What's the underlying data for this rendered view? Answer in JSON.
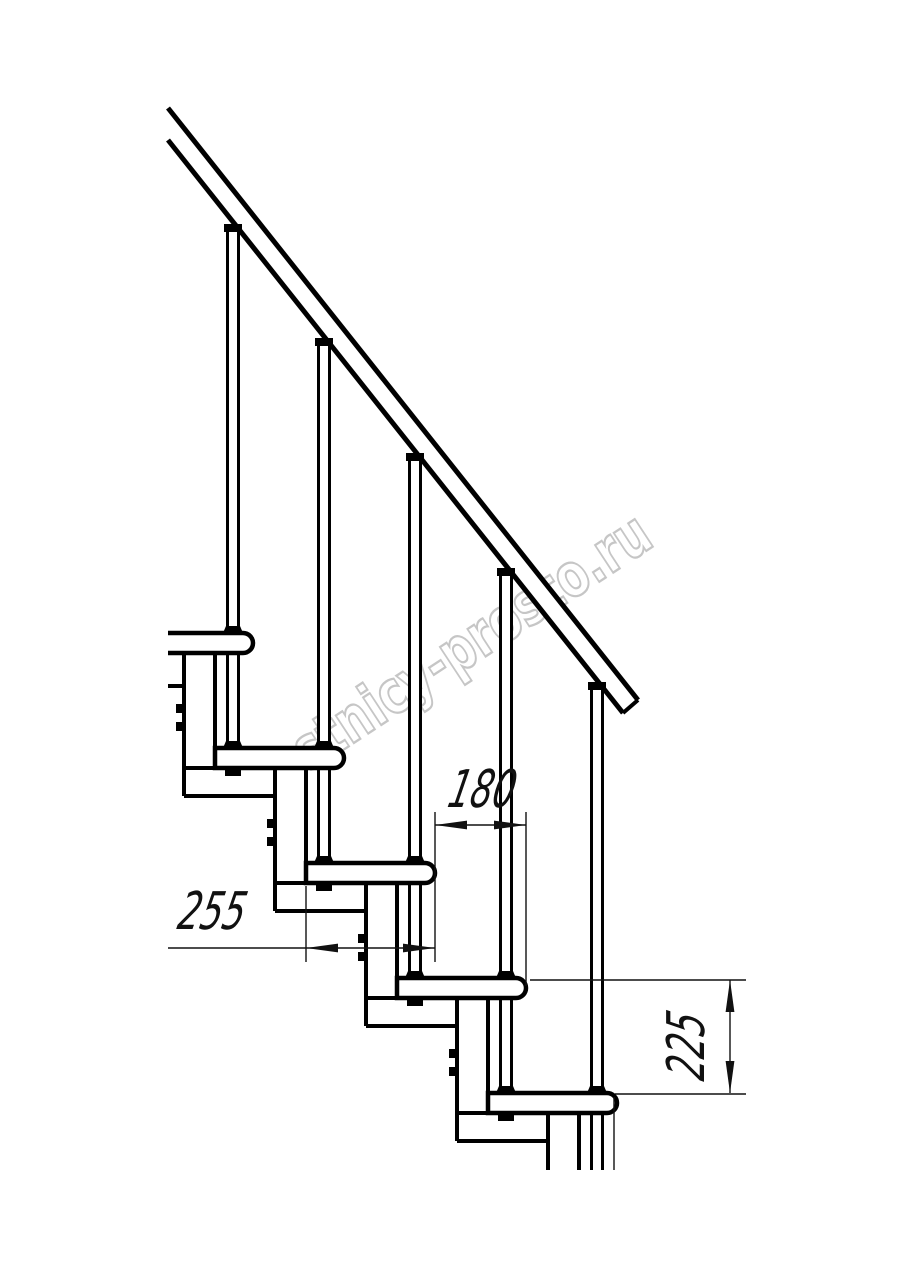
{
  "page": {
    "background_color": "#ffffff",
    "type": "technical-line-drawing",
    "subject": "Modular staircase side elevation with handrail, balusters, five treads, central support columns and dimension callouts"
  },
  "watermark": {
    "text": "lestnicy-prosto.ru",
    "outline_color": "#c6c6c6",
    "fill_color": "#ffffff"
  },
  "drawing": {
    "line_color": "#000000",
    "dimension_color": "#111111",
    "tread_count": 5,
    "baluster_count": 5,
    "handrail_present": true
  },
  "dimensions": {
    "step_run": {
      "label": "180"
    },
    "tread_depth": {
      "label": "255"
    },
    "riser_height": {
      "label": "225"
    }
  }
}
